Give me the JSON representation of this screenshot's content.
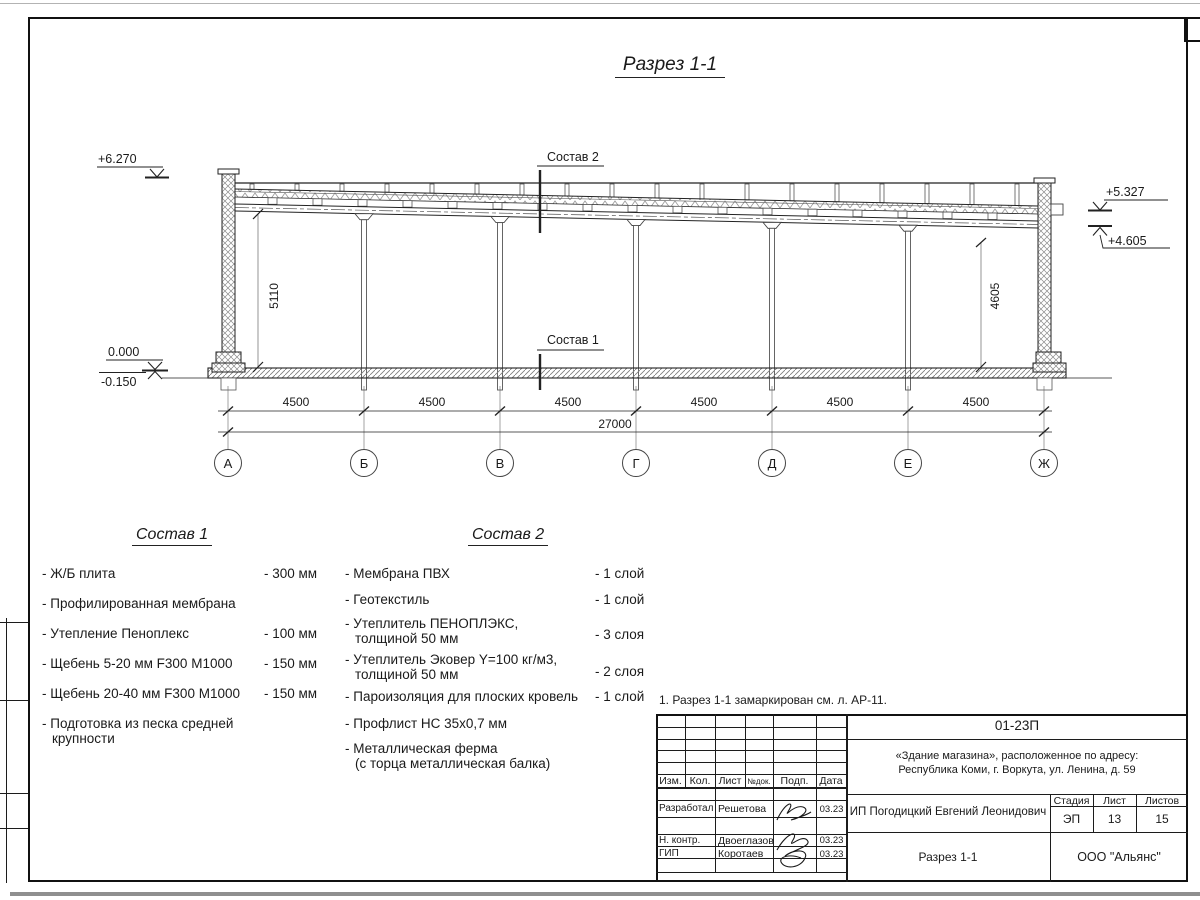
{
  "colors": {
    "ink": "#1a1a1a",
    "hatch": "#8a8a8a",
    "paper": "#ffffff"
  },
  "drawing": {
    "title": "Разрез 1-1",
    "callouts": {
      "sostav1": "Состав 1",
      "sostav2": "Состав 2"
    },
    "elevations": {
      "parapet_top": "+6.270",
      "roof_right_top": "+5.327",
      "beam_right_bottom": "+4.605",
      "floor_zero": "0.000",
      "ground": "-0.150"
    },
    "vertical_dims": {
      "left": "5110",
      "right": "4605"
    },
    "axes": [
      "А",
      "Б",
      "В",
      "Г",
      "Д",
      "Е",
      "Ж"
    ],
    "bay_dims": [
      "4500",
      "4500",
      "4500",
      "4500",
      "4500",
      "4500"
    ],
    "total_dim": "27000"
  },
  "sostav1": {
    "title": "Состав 1",
    "items": [
      {
        "name": "- Ж/Б плита",
        "value": "- 300 мм"
      },
      {
        "name": "- Профилированная мембрана",
        "value": ""
      },
      {
        "name": "- Утепление Пеноплекс",
        "value": "- 100 мм"
      },
      {
        "name": "-  Щебень 5-20 мм F300 М1000",
        "value": "- 150 мм"
      },
      {
        "name": "-  Щебень 20-40 мм F300 М1000",
        "value": "- 150 мм"
      },
      {
        "name": "- Подготовка из песка средней\nкрупности",
        "value": ""
      }
    ]
  },
  "sostav2": {
    "title": "Состав 2",
    "items": [
      {
        "name": "- Мембрана ПВХ",
        "value": "- 1 слой"
      },
      {
        "name": "- Геотекстиль",
        "value": "- 1 слой"
      },
      {
        "name": "- Утеплитель ПЕНОПЛЭКС,\nтолщиной 50 мм",
        "value": "- 3 слоя"
      },
      {
        "name": "- Утеплитель Эковер Y=100 кг/м3,\nтолщиной 50 мм",
        "value": "- 2 слоя"
      },
      {
        "name": "- Пароизоляция для плоских кровель",
        "value": "- 1 слой"
      },
      {
        "name": "- Профлист НС 35х0,7 мм",
        "value": ""
      },
      {
        "name": "- Металлическая ферма\n(с торца металлическая балка)",
        "value": ""
      }
    ]
  },
  "note": "1. Разрез 1-1 замаркирован см. л. АР-11.",
  "titleblock": {
    "doc_number": "01-23П",
    "object_line1": "«Здание магазина», расположенное по адресу:",
    "object_line2": "Республика Коми, г. Воркута, ул. Ленина, д. 59",
    "header_cols": [
      "Изм.",
      "Кол.",
      "Лист",
      "№док.",
      "Подп.",
      "Дата"
    ],
    "signature_rows": [
      {
        "role": "Разработал",
        "name": "Решетова",
        "date": "03.23"
      },
      {
        "role": "Н. контр.",
        "name": "Двоеглазов",
        "date": "03.23"
      },
      {
        "role": "ГИП",
        "name": "Коротаев",
        "date": "03.23"
      }
    ],
    "client": "ИП Погодицкий Евгений Леонидович",
    "stage_label": "Стадия",
    "sheet_label": "Лист",
    "sheets_label": "Листов",
    "stage": "ЭП",
    "sheet_number": "13",
    "sheets_total": "15",
    "sheet_title": "Разрез 1-1",
    "company": "ООО \"Альянс\""
  }
}
